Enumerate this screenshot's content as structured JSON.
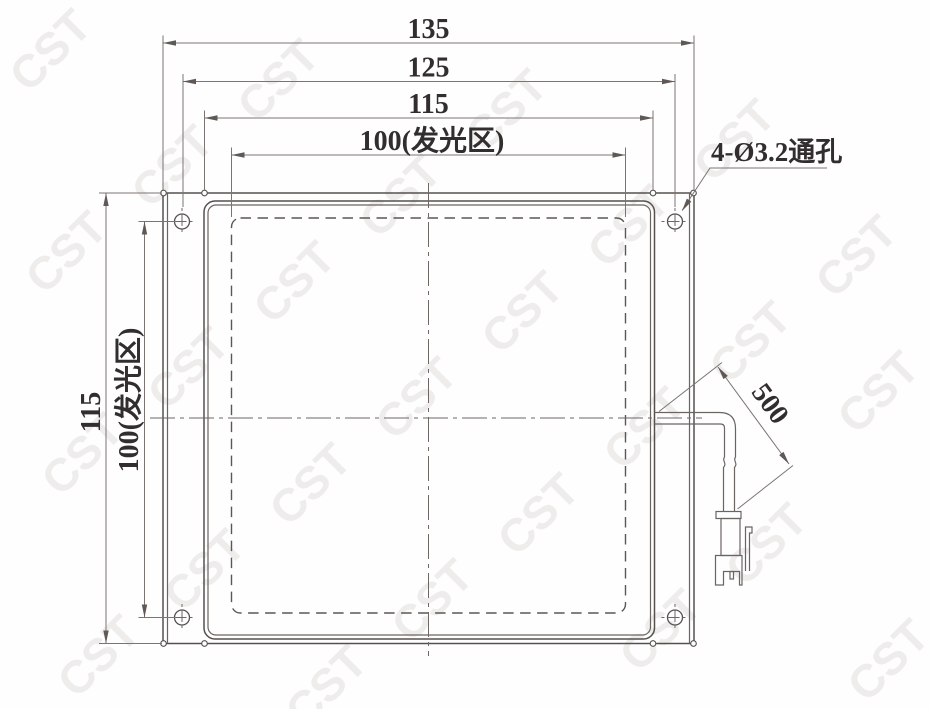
{
  "dimensions": {
    "top": [
      "135",
      "125",
      "115",
      "100(发光区)"
    ],
    "left": [
      "115",
      "100(发光区)"
    ],
    "cable_length": "500",
    "hole_callout": "4-Ø3.2通孔"
  },
  "watermark": {
    "text": "CST",
    "color": "#efedec",
    "positions": [
      [
        50,
        50
      ],
      [
        278,
        80
      ],
      [
        506,
        110
      ],
      [
        734,
        140
      ],
      [
        172,
        166
      ],
      [
        400,
        196
      ],
      [
        628,
        226
      ],
      [
        856,
        256
      ],
      [
        66,
        252
      ],
      [
        294,
        282
      ],
      [
        522,
        312
      ],
      [
        750,
        342
      ],
      [
        188,
        368
      ],
      [
        416,
        398
      ],
      [
        644,
        428
      ],
      [
        878,
        392
      ],
      [
        82,
        454
      ],
      [
        310,
        484
      ],
      [
        538,
        514
      ],
      [
        766,
        544
      ],
      [
        204,
        570
      ],
      [
        432,
        600
      ],
      [
        660,
        630
      ],
      [
        888,
        660
      ],
      [
        98,
        656
      ],
      [
        326,
        686
      ]
    ]
  },
  "colors": {
    "outline": "#56504d",
    "dimension_lines": "#7c7471",
    "text": "#332e2e",
    "background": "#fefefe"
  }
}
